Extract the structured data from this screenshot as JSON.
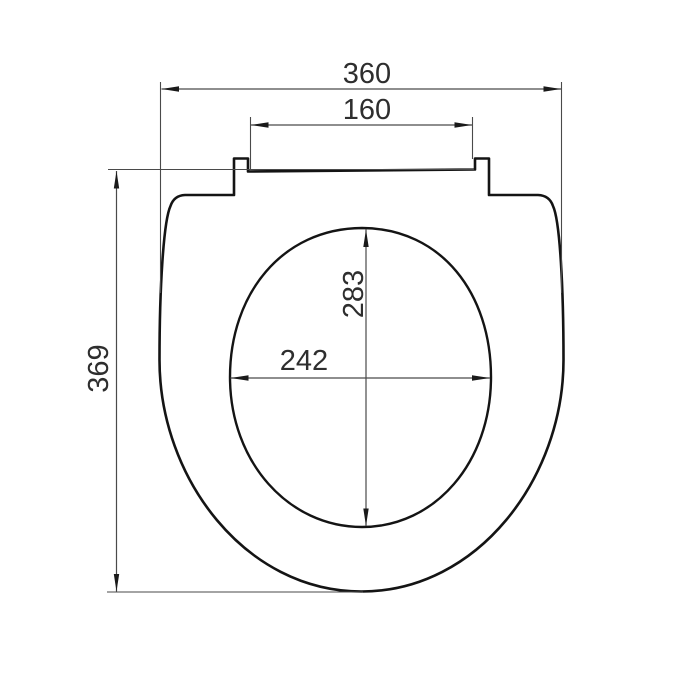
{
  "drawing": {
    "background": "#ffffff",
    "colors": {
      "outline": "#141414",
      "dimension_lines": "#4a4a4a",
      "label_text": "#2e2e2e"
    },
    "labels": {
      "overall_width": "360",
      "hinge_width": "160",
      "overall_depth": "369",
      "opening_depth": "283",
      "opening_width": "242"
    }
  }
}
